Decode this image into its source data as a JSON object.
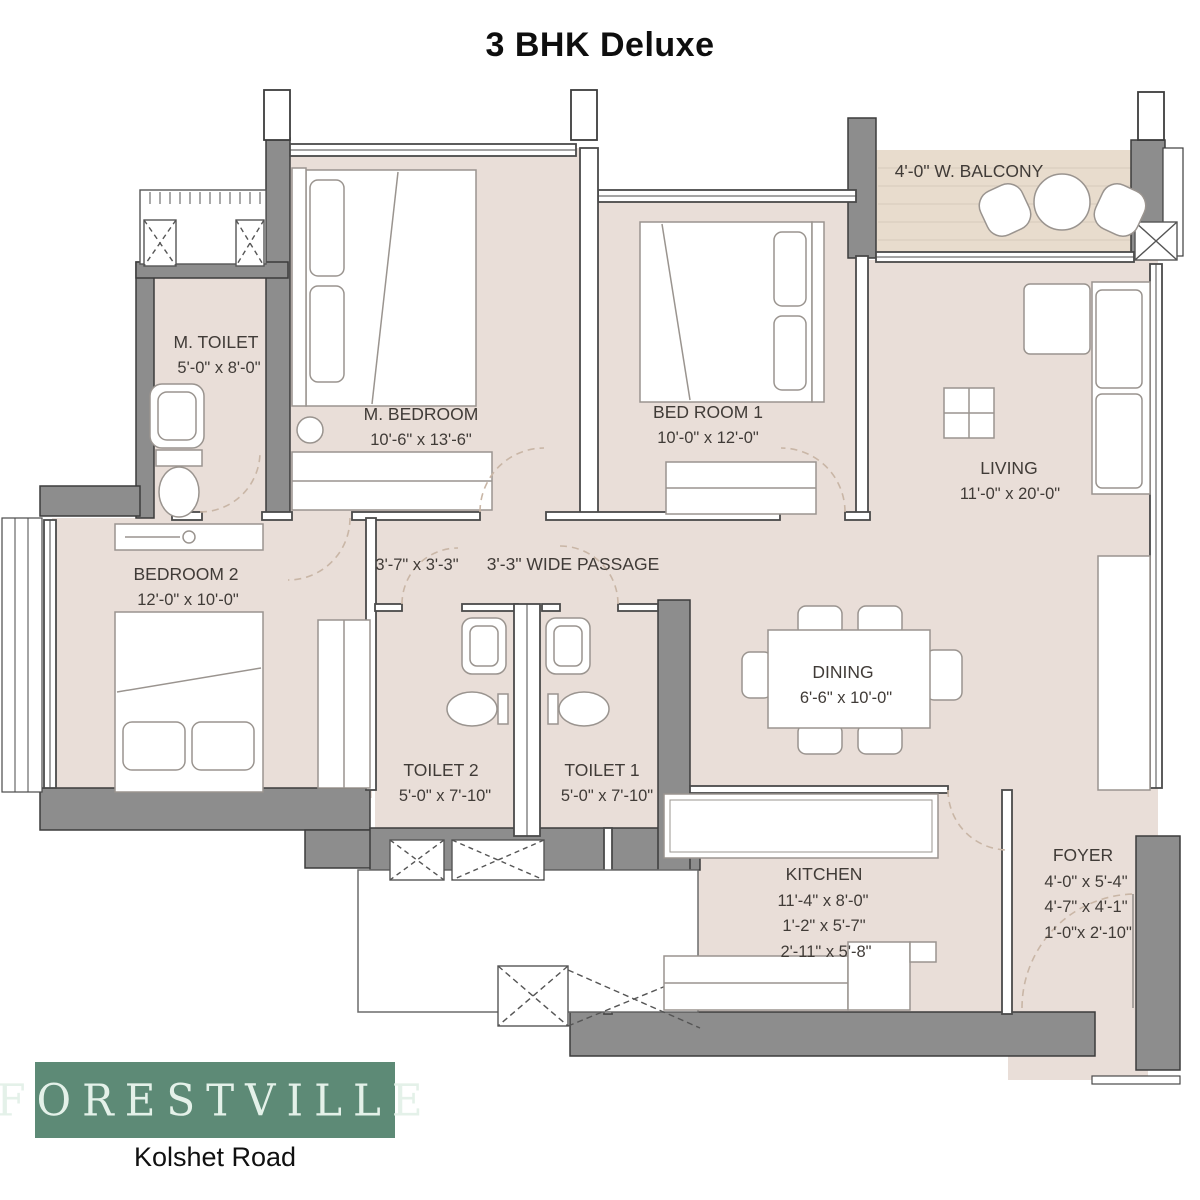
{
  "title": "3 BHK Deluxe",
  "branding": {
    "logo": "FORESTVILLE",
    "location": "Kolshet Road"
  },
  "colors": {
    "wall": "#8d8d8d",
    "wall_outline": "#3c3c3c",
    "floor": "#e9ded8",
    "balcony_floor": "#e8dccd",
    "accent_green": "#5d8a76"
  },
  "rooms": {
    "balcony": {
      "label": "4'-0\" W. BALCONY"
    },
    "m_toilet": {
      "label": "M. TOILET",
      "dims": [
        "5'-0\" x 8'-0\""
      ]
    },
    "m_bedroom": {
      "label": "M. BEDROOM",
      "dims": [
        "10'-6\" x 13'-6\""
      ]
    },
    "bedroom1": {
      "label": "BED ROOM 1",
      "dims": [
        "10'-0\" x 12'-0\""
      ]
    },
    "living": {
      "label": "LIVING",
      "dims": [
        "11'-0\" x 20'-0\""
      ]
    },
    "bedroom2": {
      "label": "BEDROOM 2",
      "dims": [
        "12'-0\" x 10'-0\""
      ]
    },
    "passage": {
      "label": "3'-3\" WIDE PASSAGE",
      "niche_dims": "3'-7\" x 3'-3\""
    },
    "dining": {
      "label": "DINING",
      "dims": [
        "6'-6\" x 10'-0\""
      ]
    },
    "toilet2": {
      "label": "TOILET 2",
      "dims": [
        "5'-0\" x 7'-10\""
      ]
    },
    "toilet1": {
      "label": "TOILET 1",
      "dims": [
        "5'-0\" x 7'-10\""
      ]
    },
    "kitchen": {
      "label": "KITCHEN",
      "dims": [
        "11'-4\" x 8'-0\"",
        "1'-2\" x 5'-7\"",
        "2'-11\" x 5'-8\""
      ]
    },
    "foyer": {
      "label": "FOYER",
      "dims": [
        "4'-0\" x 5'-4\"",
        "4'-7\" x 4'-1\"",
        "1'-0\"x 2'-10\""
      ]
    }
  }
}
